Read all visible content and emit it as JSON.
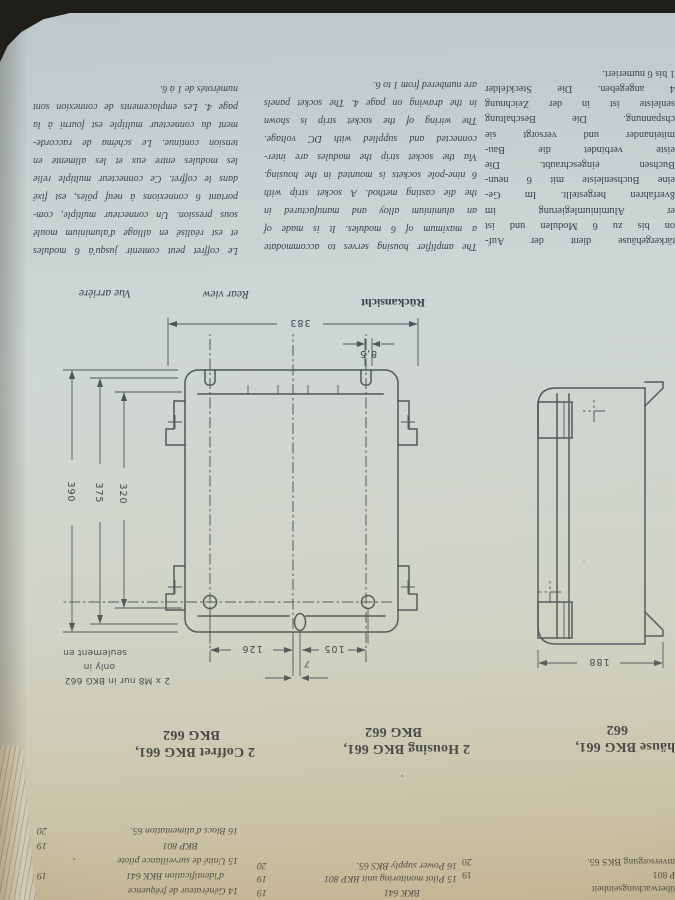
{
  "top_list": {
    "german": {
      "cut_line": "14 Kennfrequenzgenerator",
      "rows": [
        {
          "text": "überwachungseinheit",
          "page": ""
        },
        {
          "text": "P 801",
          "page": "19"
        },
        {
          "text": "mversorgung BKS 65.",
          "page": "20"
        }
      ]
    },
    "english": {
      "cut_line": "14 Identification frequency",
      "rows": [
        {
          "text": "BKK 641",
          "page": "19"
        },
        {
          "text": "15 Pilot monitoring unit BKP 801",
          "page": "19"
        },
        {
          "text": "16 Power supply BKS 65.",
          "page": "20"
        }
      ]
    },
    "french": {
      "rows": [
        {
          "text": "14 Générateur de fréquence",
          "page": ""
        },
        {
          "text": "d'identification BKK 641",
          "page": "19"
        },
        {
          "text": "15 Unité de surveillance pilote",
          "page": ""
        },
        {
          "text": "BKP 801",
          "page": "19"
        },
        {
          "text": "16 Blocs d'alimentation 65.",
          "page": "20"
        }
      ]
    }
  },
  "headings": {
    "german": {
      "line1": "häuse BKG 661,",
      "line2": "662"
    },
    "english": {
      "line1": "2 Housing BKG 661,",
      "line2": "BKG 662"
    },
    "french": {
      "line1": "2 Coffret BKG 661,",
      "line2": "BKG 662"
    }
  },
  "diagram": {
    "view_labels": {
      "german": "Rückansicht",
      "english": "Rear view",
      "french": "Vue arrière"
    },
    "dimensions": {
      "width_total": "383",
      "slot_offset": "8,5",
      "hole_left": "105",
      "hole_right": "126",
      "oval_offset": "7",
      "height_total": "390",
      "height_mid": "375",
      "height_inner": "320",
      "depth": "188"
    },
    "note": {
      "line1": "2 x M8 nur in BKG 662",
      "line2": "only in",
      "line3": "seulement en"
    }
  },
  "paragraphs": {
    "german": [
      "tärkergehäuse dient der Auf-",
      "on bis zu 6 Modulen und ist",
      "er Aluminiumlegierung im",
      "ßverfahren hergestellt. Im Ge-",
      "eine Buchsenleiste mit 6 neun-",
      "Buchsen eingeschraubt. Die",
      "eiste verbindet die Bau-",
      "miteinander und versorgt sie",
      "chspannung. Die Beschaltung",
      "senleiste ist in der Zeichnung",
      "4 angegeben. Die Steckfelder",
      "1 bis 6 numeriert."
    ],
    "english": [
      "The amplifier housing serves to accommodate",
      "a maximum of 6 modules. It is made of",
      "an aluminium alloy and manufactured in",
      "the die casting method. A socket strip with",
      "6 nine-pole sockets is mounted in the housing.",
      "Via the socket strip the modules are inter-",
      "connected and supplied with DC voltage.",
      "The wiring of the socket strip is shown",
      "in the drawing on page 4. The socket panels",
      "are numbered from 1 to 6."
    ],
    "french": [
      "Le coffret peut contenir jusqu'à 6 modules",
      "et est réalisé en alliage d'aluminium moulé",
      "sous pression. Un connecteur multiple, com-",
      "portant 6 connexions à neuf pôles, est fixé",
      "dans le coffret. Ce connecteur multiple relie",
      "les modules entre eux et les alimente en",
      "tension continue. Le schéma de raccorde-",
      "ment du connecteur multiple est fourni à la",
      "page 4. Les emplacements de connexion sont",
      "numérotés de 1 à 6."
    ]
  }
}
